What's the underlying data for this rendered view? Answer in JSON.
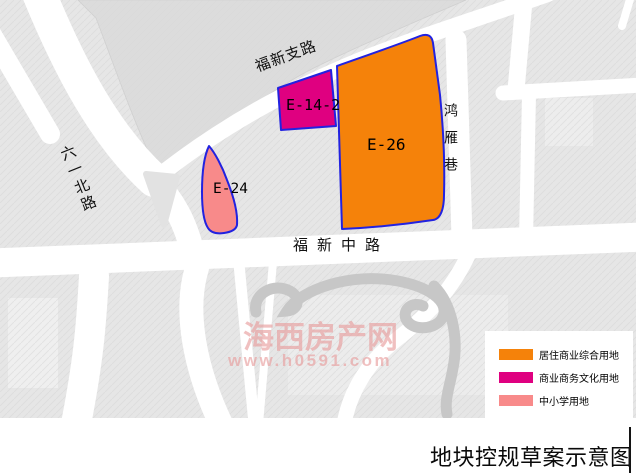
{
  "title": {
    "text": "地块控规草案示意图"
  },
  "map": {
    "roads": {
      "fuxin_branch": "福新支路",
      "liuyi_north": "六一北路",
      "hongyan_lane": "鸿雁巷",
      "fuxin_middle": "福新中路"
    },
    "parcels": [
      {
        "id": "E-14-2",
        "color": "#DF0080"
      },
      {
        "id": "E-26",
        "color": "#F5820A"
      },
      {
        "id": "E-24",
        "color": "#F88A8A"
      }
    ],
    "parcel_border_color": "#2222E0"
  },
  "watermark": {
    "line1": "海西房产网",
    "line2": "www.h0591.com",
    "color": "#E89B9B"
  },
  "legend": {
    "items": [
      {
        "label": "居住商业综合用地",
        "color": "#F5820A"
      },
      {
        "label": "商业商务文化用地",
        "color": "#DF0080"
      },
      {
        "label": "中小学用地",
        "color": "#F88A8A"
      }
    ]
  }
}
